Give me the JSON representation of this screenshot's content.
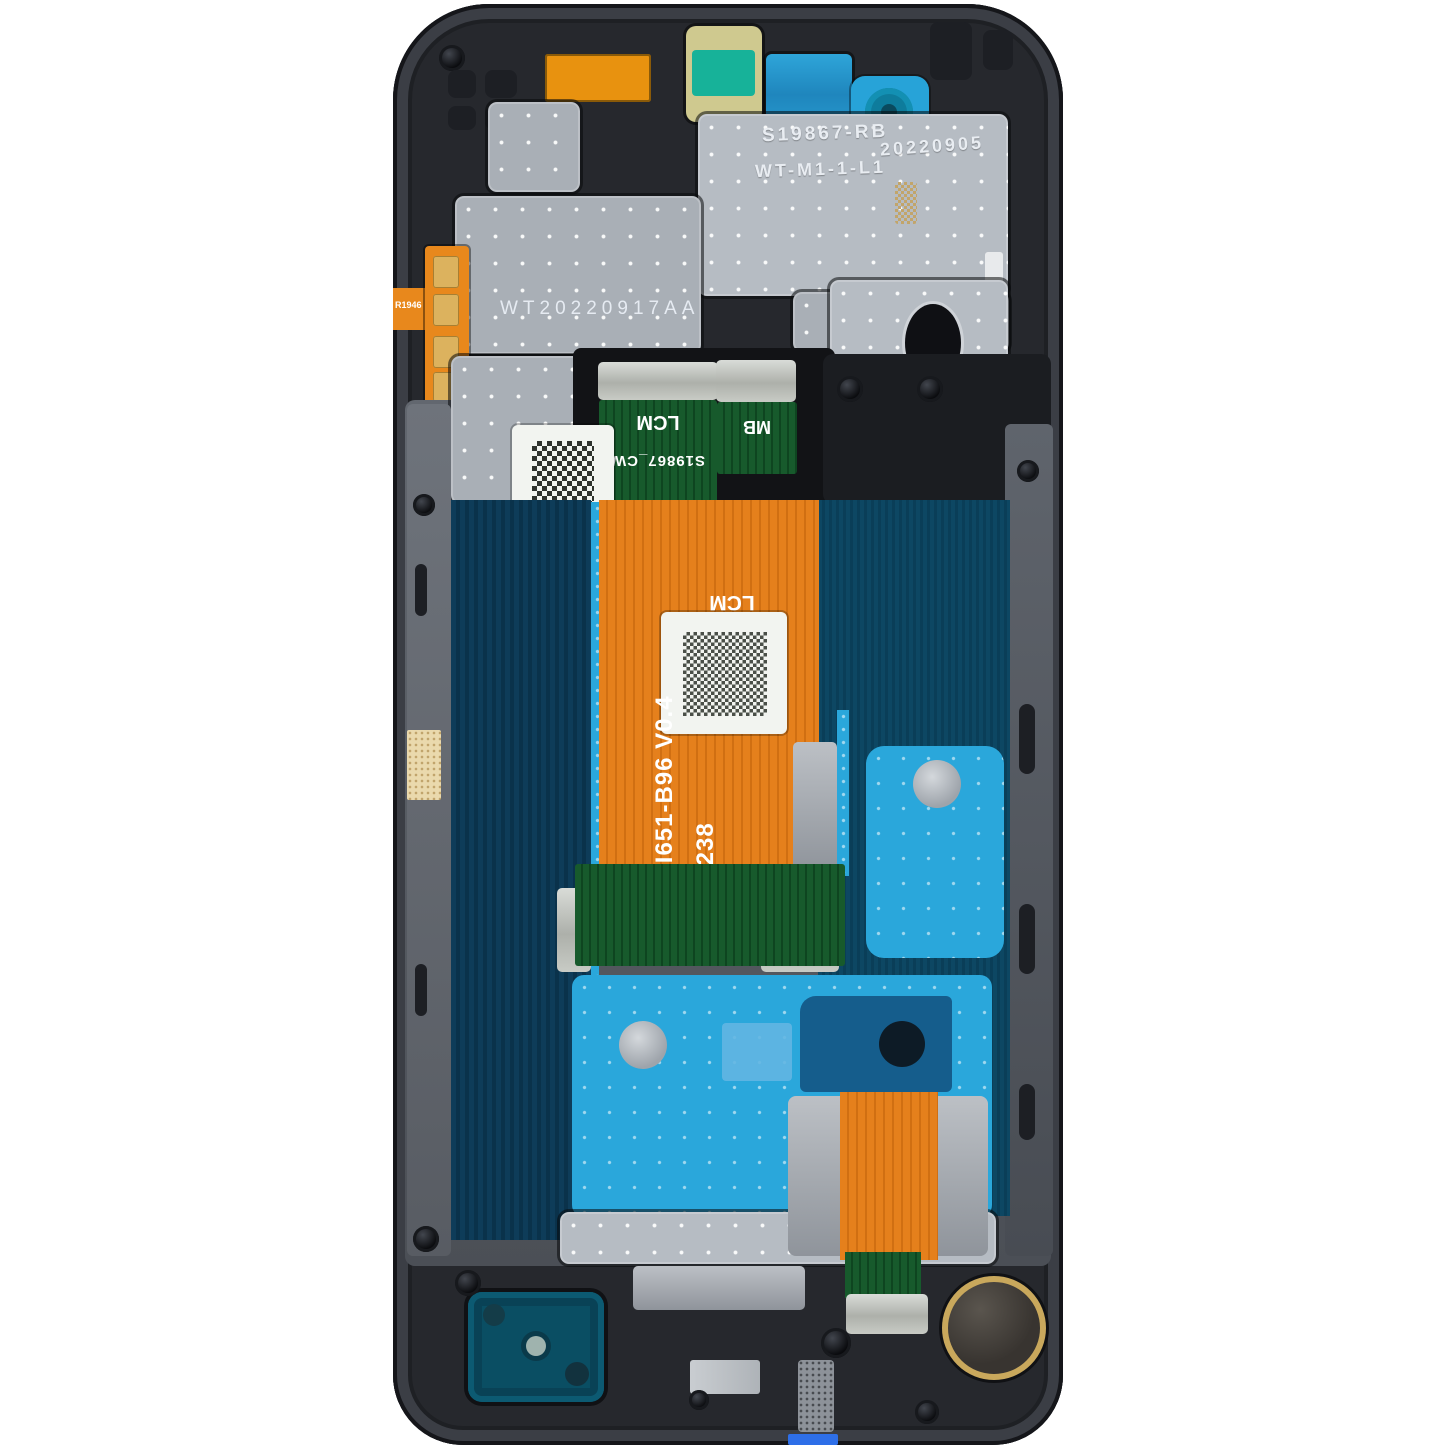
{
  "markings": {
    "shield_line1": "S19867-RB",
    "shield_line2": "WT-M1-1-L1",
    "shield_date": "20220905",
    "etched_code": "WT20220917AA",
    "lcm_tail_label": "LCM",
    "lcm_tail_part": "S19867_CW",
    "mb_tail_label": "MB",
    "flex_lcm_label": "LCM",
    "flex_model": "SKI651-B96  V0.4",
    "flex_lot": "5 2238",
    "side_flex_code": "R1946"
  },
  "colors": {
    "background": "#ffffff",
    "frame_plastic": "#26282d",
    "metal_plate": "#a9afb6",
    "graphite_navy_panel": "#0e3c59",
    "display_teal_panel": "#0d4763",
    "adhesive_cyan": "#2aa7db",
    "flex_orange": "#e5801c",
    "flex_green": "#175a2c",
    "speaker_teal": "#0a4e63",
    "motor_rim_gold": "#c9a85c",
    "label_white": "#f2f4f0",
    "bottom_tab_blue": "#2e6fe8"
  }
}
